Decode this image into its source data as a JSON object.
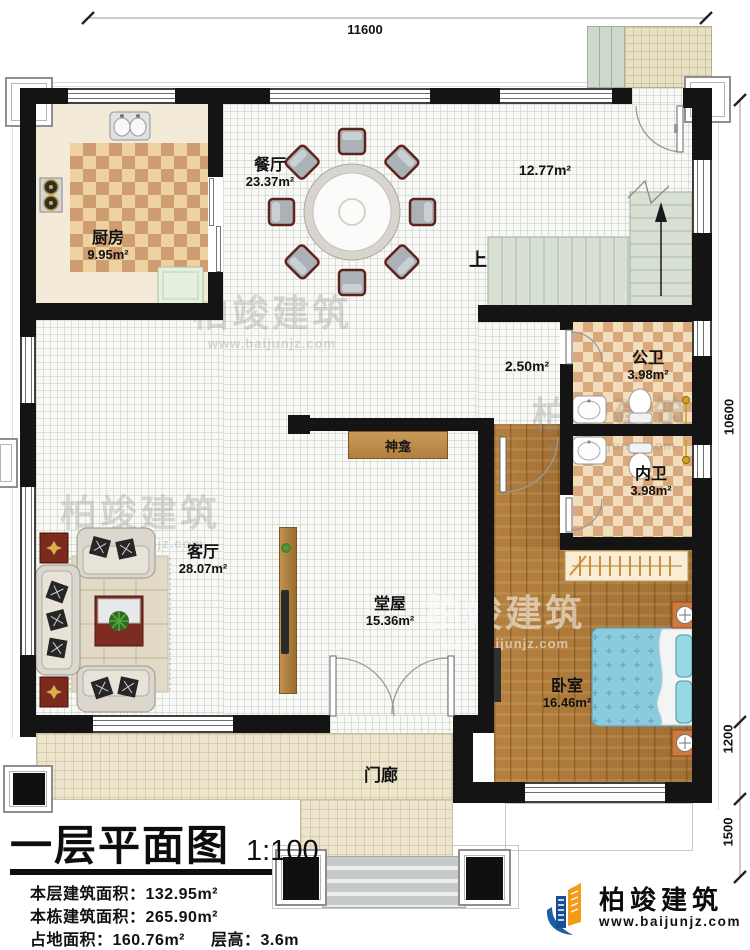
{
  "plan": {
    "dims": {
      "top": "11600",
      "right_upper": "10600",
      "right_mid": "1200",
      "right_lower": "1500"
    },
    "rooms": {
      "kitchen": {
        "label": "厨房",
        "area": "9.95m²"
      },
      "dining": {
        "label": "餐厅",
        "area": "23.37m²"
      },
      "stair_hall": {
        "area": "12.77m²"
      },
      "inner_hall": {
        "area": "2.50m²"
      },
      "public_bath": {
        "label": "公卫",
        "area": "3.98m²"
      },
      "private_bath": {
        "label": "内卫",
        "area": "3.98m²"
      },
      "living": {
        "label": "客厅",
        "area": "28.07m²"
      },
      "main_hall": {
        "label": "堂屋",
        "area": "15.36m²"
      },
      "bedroom": {
        "label": "卧室",
        "area": "16.46m²"
      },
      "porch": {
        "label": "门廊"
      },
      "shrine": {
        "label": "神龛"
      },
      "stairs": {
        "up_label": "上"
      }
    },
    "title_block": {
      "title": "一层平面图",
      "scale": "1:100",
      "line1": "本层建筑面积：132.95m²",
      "line2": "本栋建筑面积：265.90m²",
      "line3_left": "占地面积：160.76m²",
      "line3_right": "层高：3.6m"
    },
    "branding": {
      "logo_text": "柏竣建筑",
      "logo_url": "www.baijunjz.com",
      "watermark_text": "柏竣建筑",
      "watermark_url": "www.baijunjz.com"
    },
    "colors": {
      "wall": "#141414",
      "logo_blue": "#1c5fa8",
      "logo_orange": "#f49a16",
      "wood_floor": "#ad783c",
      "tile_light": "#eed1a0",
      "tile_dark": "#cf9d6f",
      "stair": "#d7e0d3",
      "bed_blue": "#8ccade",
      "porch": "#ece5cb"
    }
  }
}
